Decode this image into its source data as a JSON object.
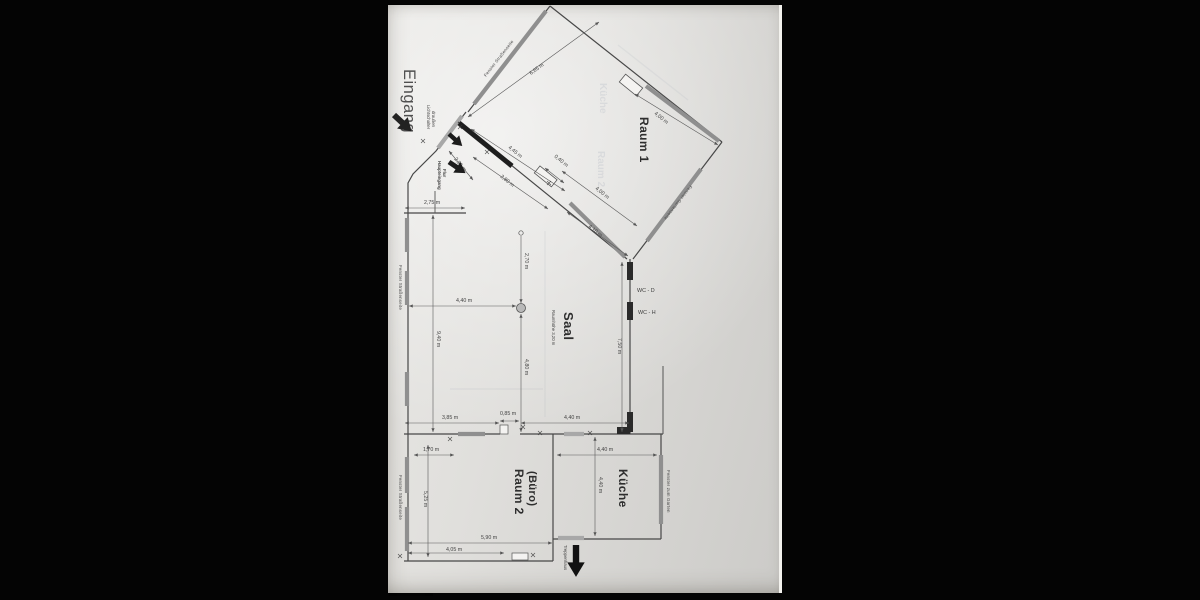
{
  "plan": {
    "labels": {
      "eingang": "Eingang",
      "raum1": "Raum 1",
      "saal": "Saal",
      "saal_sub": "Raumhöhe 3,20 m",
      "raum2_l1": "Raum 2",
      "raum2_l2": "(Büro)",
      "kueche": "Küche",
      "wc_d": "WC - D",
      "wc_h": "WC - H",
      "treppenhaus": "Treppenhaus",
      "haupteingang_l1": "Haupteingang",
      "haupteingang_l2": "Flur",
      "note_l1": "Lichtschalter",
      "note_l2": "draußen"
    },
    "window_labels": {
      "street_top": "Fenster Straßenseite",
      "street_saal": "Fenster Straßenseite",
      "street_raum2": "Fenster Straßenseite",
      "garden_raum1": "Fenster Gartenseite",
      "garden_kueche": "Fenster zum Garten"
    },
    "dims": {
      "r1_diag": "6,65 m",
      "r1_ne": "4,00 m",
      "corr_445": "4,45 m",
      "corr_280": "2,80 m",
      "corr_255": "2,55 m",
      "door_040": "0,40 m",
      "sw_400": "4,00 m",
      "sw_410": "4,10 m",
      "w_275": "2,75 m",
      "saal_440": "4,40 m",
      "saal_270": "2,70 m",
      "saal_940": "9,40 m",
      "saal_480": "4,80 m",
      "saal_750": "7,50 m",
      "bot_385": "3,85 m",
      "bot_085": "0,85 m",
      "bot_440": "4,40 m",
      "r2_170": "1,70 m",
      "r2_525": "5,25 m",
      "r2_590": "5,90 m",
      "r2_405": "4,05 m",
      "k_440h": "4,40 m",
      "k_440v": "4,40 m"
    },
    "ghosts": {
      "g1": "Küche",
      "g2": "Raum 2"
    }
  }
}
